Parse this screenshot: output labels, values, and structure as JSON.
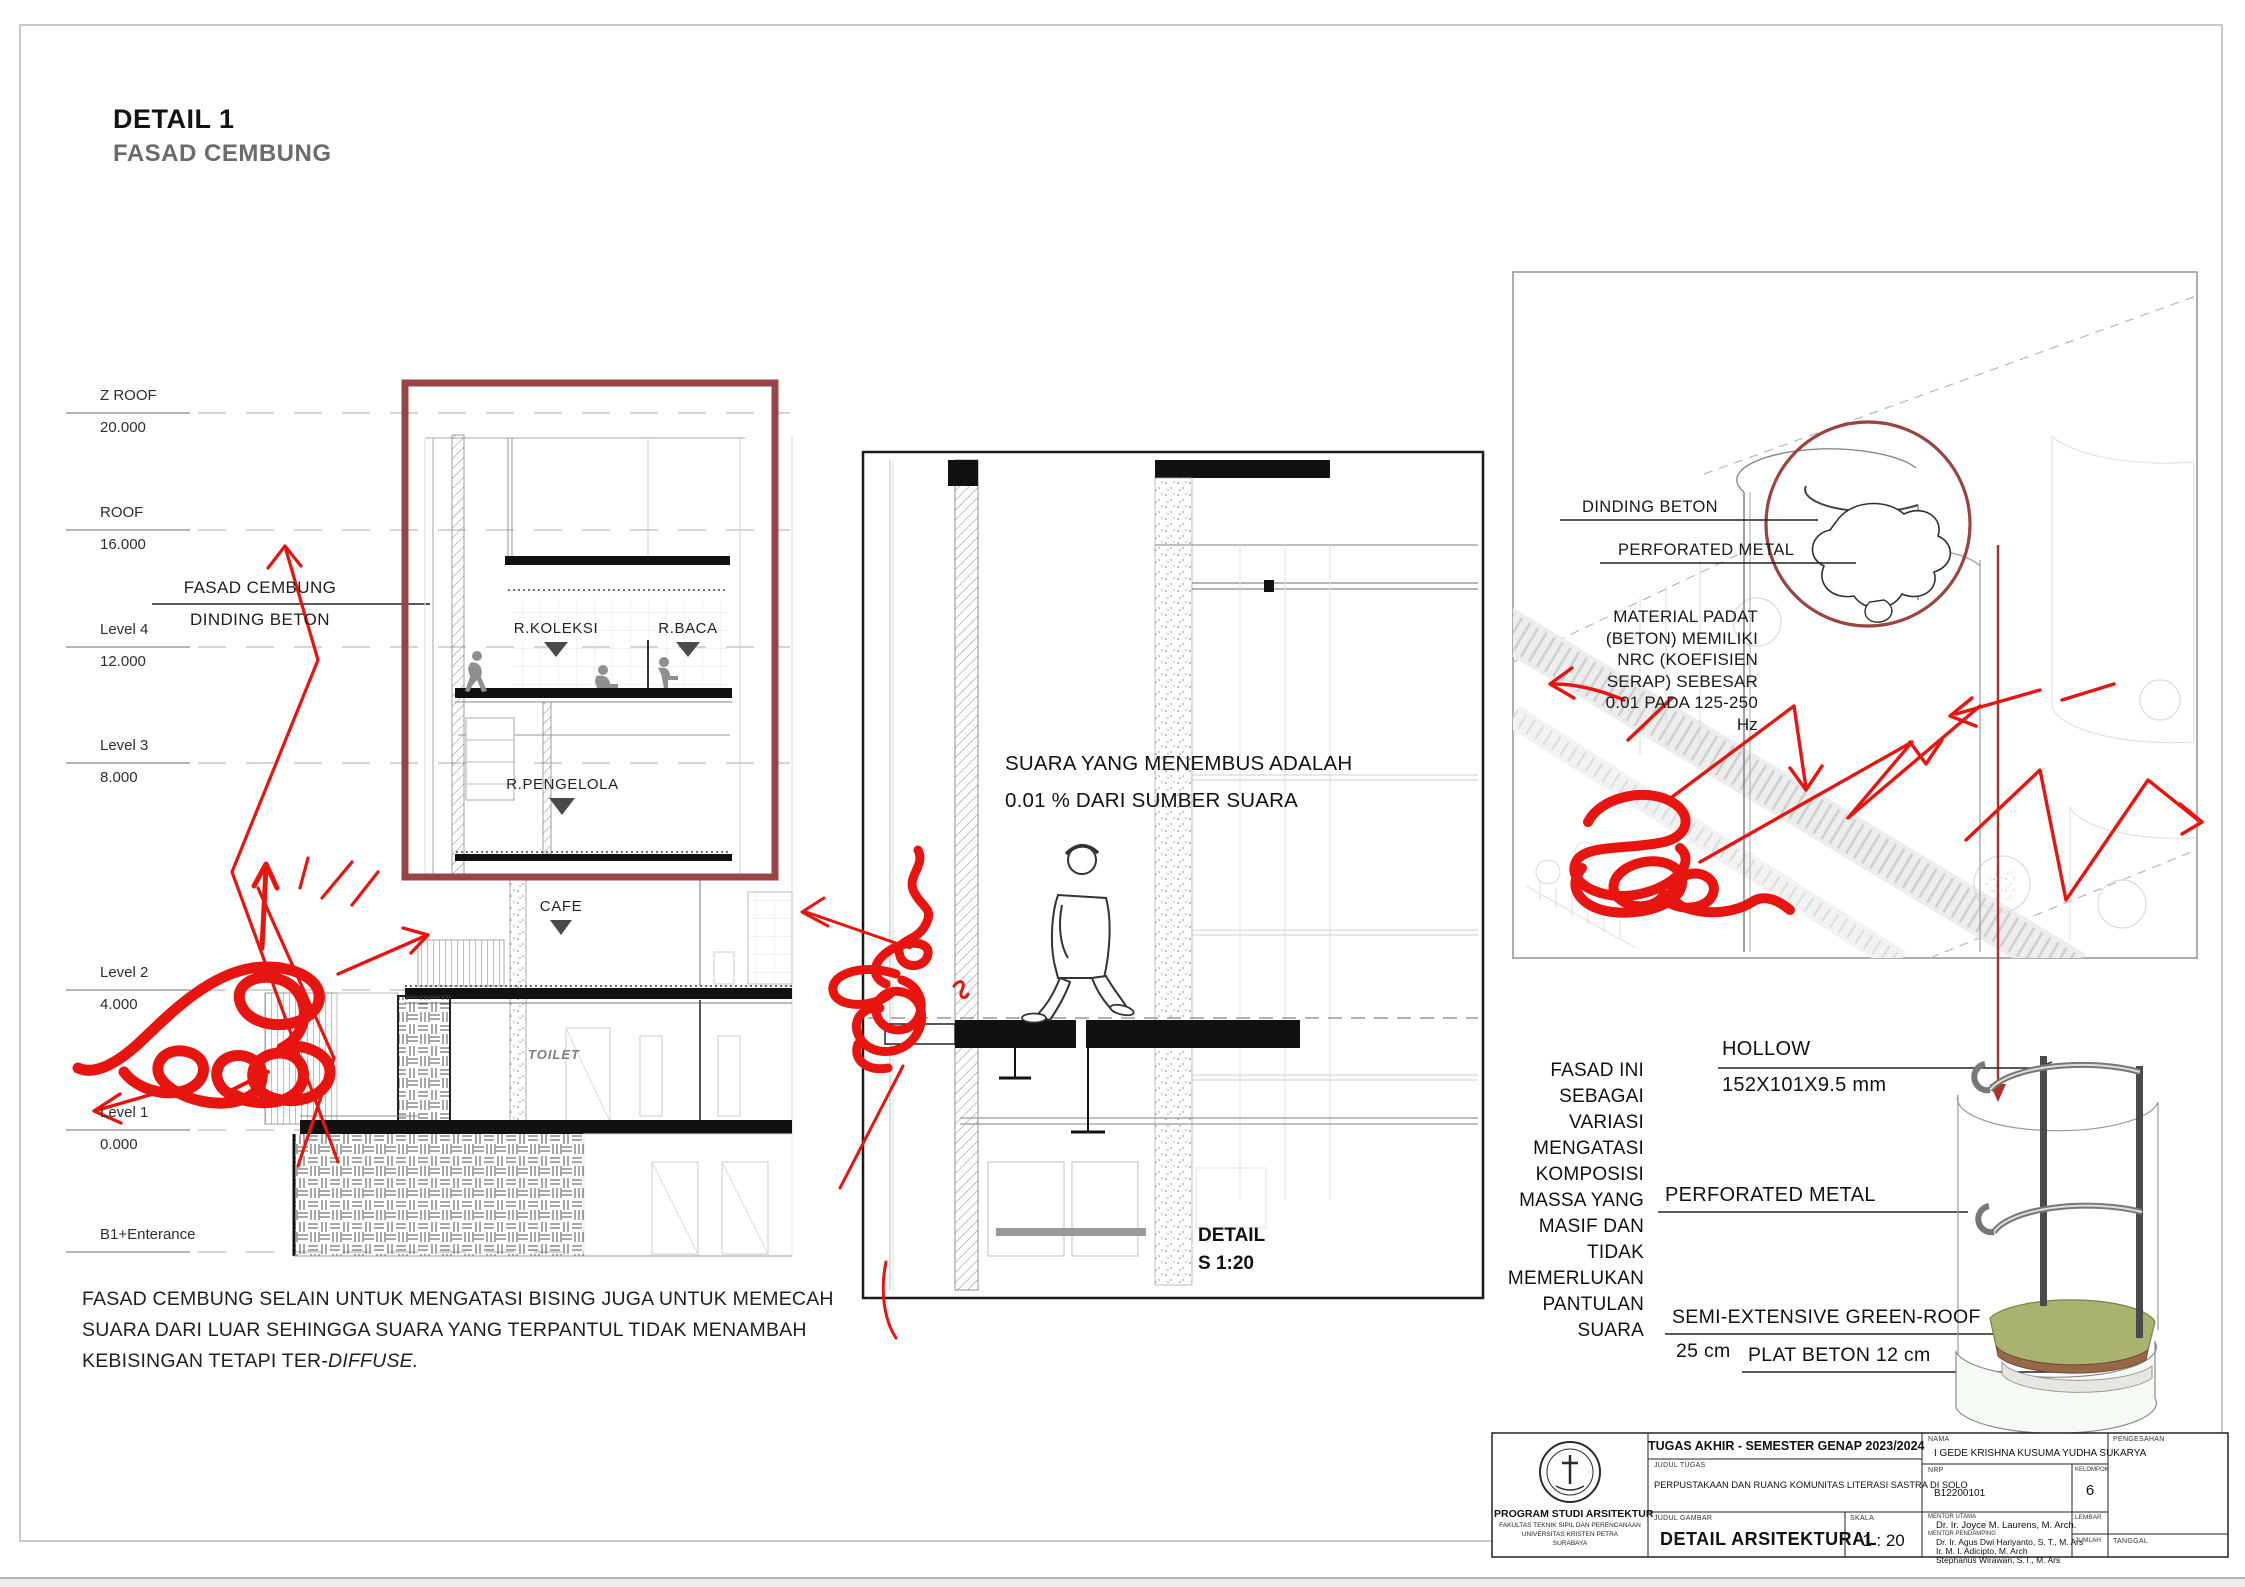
{
  "page": {
    "title": "DETAIL 1",
    "subtitle": "FASAD CEMBUNG"
  },
  "levels": [
    {
      "name": "Z ROOF",
      "elev": "20.000"
    },
    {
      "name": "ROOF",
      "elev": "16.000"
    },
    {
      "name": "Level 4",
      "elev": "12.000"
    },
    {
      "name": "Level 3",
      "elev": "8.000"
    },
    {
      "name": "Level 2",
      "elev": "4.000"
    },
    {
      "name": "Level 1",
      "elev": "0.000"
    },
    {
      "name": "B1+Enterance",
      "elev": ""
    }
  ],
  "section": {
    "facade_line1": "FASAD CEMBUNG",
    "facade_line2": "DINDING BETON",
    "rooms": {
      "koleksi": "R.KOLEKSI",
      "baca": "R.BACA",
      "pengelola": "R.PENGELOLA",
      "cafe": "CAFE",
      "toilet": "TOILET"
    },
    "caption_lines": [
      "FASAD CEMBUNG SELAIN UNTUK MENGATASI BISING JUGA UNTUK MEMECAH",
      "SUARA DARI LUAR SEHINGGA SUARA YANG TERPANTUL TIDAK MENAMBAH",
      "KEBISINGAN TETAPI TER-"
    ],
    "caption_italic": "DIFFUSE."
  },
  "detail_panel": {
    "note_line1": "SUARA YANG MENEMBUS ADALAH",
    "note_line2": "0.01 % DARI SUMBER SUARA",
    "label": "DETAIL",
    "scale": "S 1:20"
  },
  "iso_panel": {
    "label_dinding": "DINDING BETON",
    "label_perforated": "PERFORATED METAL",
    "note": [
      "MATERIAL PADAT",
      "(BETON) MEMILIKI",
      "NRC (KOEFISIEN",
      "SERAP) SEBESAR",
      "0.01 PADA 125-250",
      "Hz"
    ]
  },
  "component": {
    "note": [
      "FASAD INI",
      "SEBAGAI",
      "VARIASI",
      "MENGATASI",
      "KOMPOSISI",
      "MASSA YANG",
      "MASIF DAN",
      "TIDAK",
      "MEMERLUKAN",
      "PANTULAN",
      "SUARA"
    ],
    "hollow_label": "HOLLOW",
    "hollow_size": "152X101X9.5 mm",
    "perforated_label": "PERFORATED METAL",
    "greenroof_label": "SEMI-EXTENSIVE GREEN-ROOF",
    "greenroof_size": "25 cm",
    "plat_label": "PLAT  BETON 12 cm"
  },
  "titleblock": {
    "header": "TUGAS AKHIR - SEMESTER GENAP 2023/2024",
    "judul_tugas_label": "JUDUL TUGAS",
    "judul_tugas": "PERPUSTAKAAN DAN RUANG KOMUNITAS LITERASI SASTRA DI SOLO",
    "judul_gambar_label": "JUDUL GAMBAR",
    "judul_gambar": "DETAIL ARSITEKTURAL",
    "skala_label": "SKALA",
    "skala": "1 : 20",
    "nama_label": "NAMA",
    "nama": "I GEDE KRISHNA KUSUMA YUDHA SUKARYA",
    "nrp_label": "NRP",
    "nrp": "B12200101",
    "kelompok_label": "KELOMPOK",
    "kelompok": "6",
    "mentor_utama_label": "MENTOR UTAMA",
    "mentor_utama": "Dr. Ir. Joyce M. Laurens, M. Arch.",
    "mentor_pendamping_label": "MENTOR PENDAMPING",
    "mentor_pendamping": [
      "Dr. Ir. Agus Dwi Hariyanto, S. T., M. Ars",
      "Ir. M. I. Adicipto, M. Arch",
      "Stephanus Wirawan, S.T., M. Ars"
    ],
    "lembar_label": "LEMBAR",
    "jumlah_label": "JUMLAH",
    "pengesahan_label": "PENGESAHAN",
    "tanggal_label": "TANGGAL",
    "program": "PROGRAM STUDI ARSITEKTUR",
    "fakultas": "FAKULTAS TEKNIK SIPIL DAN PERENCANAAN",
    "universitas": "UNIVERSITAS KRISTEN PETRA",
    "kota": "SURABAYA"
  },
  "colors": {
    "accent_maroon": "#9a4545",
    "annotation_red": "#e81410",
    "triangle_gray": "#4a4a4a",
    "subtitle_gray": "#6b6b6b"
  }
}
